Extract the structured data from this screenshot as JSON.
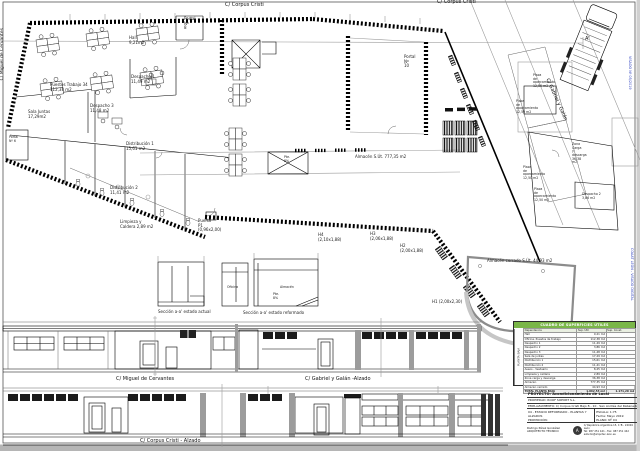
{
  "streets": {
    "corpus": "C/ Corpus Cristi",
    "miguel": "C/ Miguel de Cervantes",
    "gabriel": "C/ Gabriel y Galán"
  },
  "elevations": {
    "miguel": "C/ Miguel de Cervantes",
    "gabriel": "C/ Gabriel y Galán -Alzado",
    "corpus": "C/ Corpus Cristi - Alzado"
  },
  "sections": {
    "actual": "Sección a-a' estado actual",
    "reformado": "Sección a-a' estado reformado",
    "oficina": "Oficina",
    "almacen": "Almacén",
    "pte": "Pte.\n8%"
  },
  "rooms": {
    "hall": "Hall\n9,21m2",
    "portal8": "Portal\nNº\n8",
    "portal10": "Portal\nNº\n10",
    "portal6": "Portal\nNº 6",
    "puestos": "Puestos Trabajo 34\n112,38 m2",
    "sala_juntas": "Sala Juntas\n17,29m2",
    "despacho1": "Despacho 1\n11,49 m2",
    "despacho3": "Despacho 3\n11,48 m2",
    "distribucion1": "Distribución 1\n15,61 m2",
    "distribucion2": "Distribución 2\n11,41 m2",
    "limpieza": "Limpieza y\nCaldera 2,89 m2",
    "almacen": "Almacén S.Út. 777,35 m2",
    "zona_carga": "Zona\nCarga\ny\ndescarga\n36,38\nm2",
    "despacho2": "Despacho 2\n3,86 m2",
    "almacen_cerrado": "Almacén cerrado S.Út. 44,93 m2"
  },
  "openings": {
    "p1": "Puerta\nP1\n(0,96x2,00)",
    "h4": "H4\n(2,10x1,88)",
    "h3": "H3\n(2,06x1,88)",
    "h2": "H2\n(2,00x1,88)",
    "h1": "H1 (2,00x2,30)",
    "pte_plan": "Pte.\n8%",
    "marker_a": "A'"
  },
  "parking": {
    "label": "Plaza\nde\naparcamiento\n12,50 m2"
  },
  "watermarks": {
    "v1": "VISADO Nº 05/2019",
    "v2": "COAAT LEÓN - VISADO DIGITAL"
  },
  "table": {
    "title": "CUADRO DE SUPERFICIES ÚTILES",
    "zone": "PLANTA BAJA",
    "col_room": "Dependencia",
    "col_util": "Sup. Útil",
    "col_cons": "Sup. Const.",
    "rows": [
      {
        "name": "Hall",
        "util": "9,21 m2"
      },
      {
        "name": "Oficina. Puestos de trabajo",
        "util": "112,38 m2"
      },
      {
        "name": "Despacho 1",
        "util": "11,49 m2"
      },
      {
        "name": "Despacho 2",
        "util": "3,86 m2"
      },
      {
        "name": "Despacho 3",
        "util": "11,48 m2"
      },
      {
        "name": "Sala de juntas",
        "util": "17,29 m2"
      },
      {
        "name": "Distribución 1",
        "util": "15,61 m2"
      },
      {
        "name": "Distribución 2",
        "util": "11,41 m2"
      },
      {
        "name": "Aseos - Vestuario",
        "util": "8,25 m2"
      },
      {
        "name": "Limpieza y caldera",
        "util": "2,89 m2"
      },
      {
        "name": "Zona carga y descarga",
        "util": "36,38 m2"
      },
      {
        "name": "Almacén",
        "util": "777,35 m2"
      },
      {
        "name": "Almacén cerrado",
        "util": "44,93 m2"
      }
    ],
    "total_label": "TOTAL PLANTA BAJA",
    "total_util": "1.062,53 m2",
    "total_cons": "1.171,20 m2"
  },
  "titleblock": {
    "proyecto": "PROYECTO: Acondicionamiento de Local",
    "propiedad": "PROPIEDAD: ROOF SOPORT S.L.",
    "emplazamiento": "EMPLAZAMIENTO: C/ Corpus Cristi Bajo 8 - 10 · San Andrés del Rabanedo, 24010 - León",
    "contenido": "04 - ESTADO REFORMADO - PLANTAS Y ALZADOS",
    "promocion": "PROMOCIÓN:",
    "escala": "ESCALA: 1:75",
    "fecha": "Fecha: Mayo 2019",
    "plano": "PLANO: Nº 04",
    "autor": "Rodrigo Pérez González",
    "cargo": "ARQUITECTO TÉCNICO",
    "stamp": "A",
    "contact1": "C/ República Argentina 15, 1ºB - 24004 León",
    "contact2": "Tel: 987 251 441 - Fax: 987 251 442",
    "contact3": "estudio@arquitec-leon.es"
  }
}
